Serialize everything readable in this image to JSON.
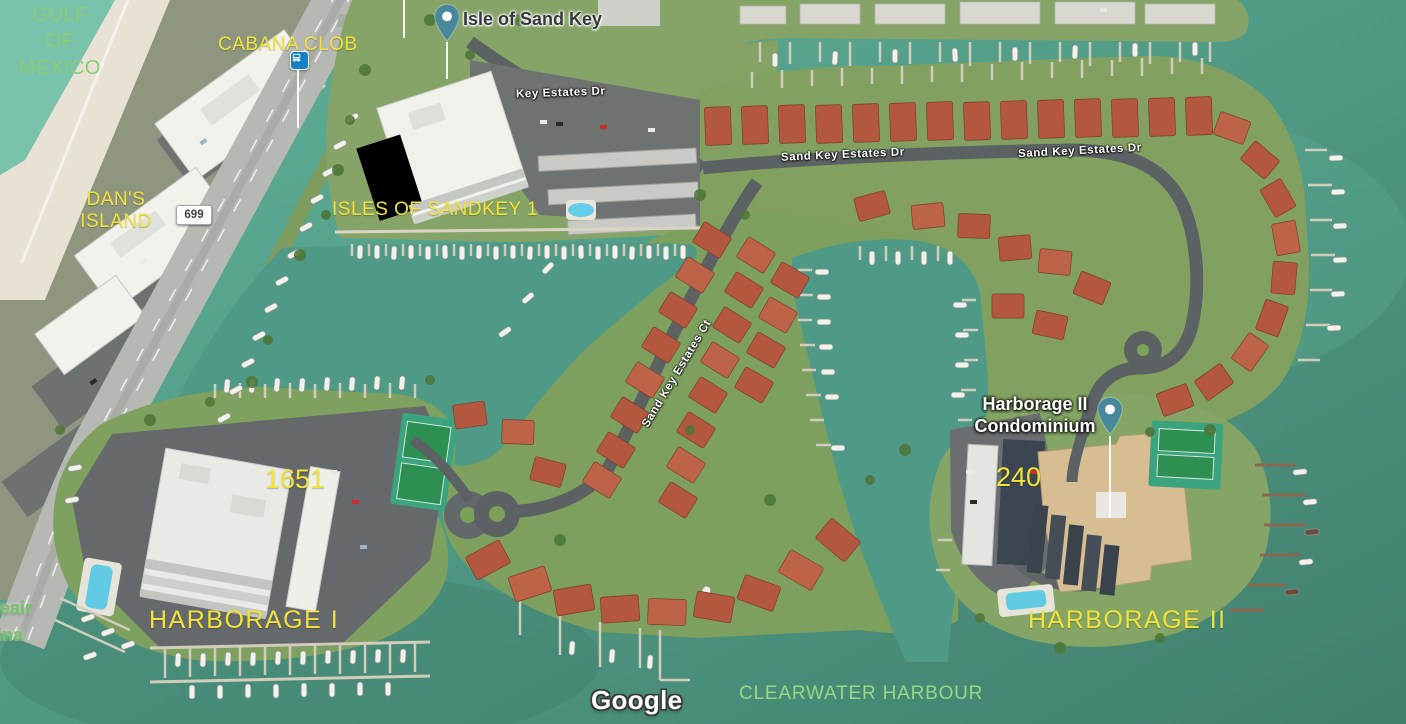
{
  "map": {
    "view": "satellite",
    "attribution": "Google"
  },
  "labels": {
    "gulf_of_mexico": "GULF\nOF\nMEXICO",
    "cabana_club": "CABANA CLOB",
    "isle_of_sand_key": "Isle of Sand Key",
    "dans_island": "DAN'S\nISLAND",
    "route_699": "699",
    "isles_of_sandkey_1": "ISLES OF SANDKEY 1",
    "key_estates_dr": "Key Estates Dr",
    "sand_key_estates_dr_west": "Sand Key Estates Dr",
    "sand_key_estates_dr_east": "Sand Key Estates Dr",
    "sand_key_estates_ct": "Sand Key Estates Ct",
    "harborage_ii_condominium": "Harborage II\nCondominium",
    "address_240": "240",
    "address_1651": "1651",
    "harborage_i": "HARBORAGE I",
    "harborage_ii": "HARBORAGE II",
    "marina_label_partial": "lleair\nrina",
    "clearwater_harbour": "CLEARWATER HARBOUR",
    "google": "Google"
  },
  "colors": {
    "overlay_yellow": "#f2e33a",
    "overlay_green": "#8bcc79",
    "water": "#4f9c88",
    "street_label": "#ffffff",
    "place_pin_teal": "#47899b",
    "bus_icon_blue": "#1580c4",
    "route_badge_bg": "#fdfdfb"
  },
  "icons": {
    "isle_pin": "map-pin",
    "harborage_pin": "map-pin",
    "bus_stop": "bus-stop"
  }
}
